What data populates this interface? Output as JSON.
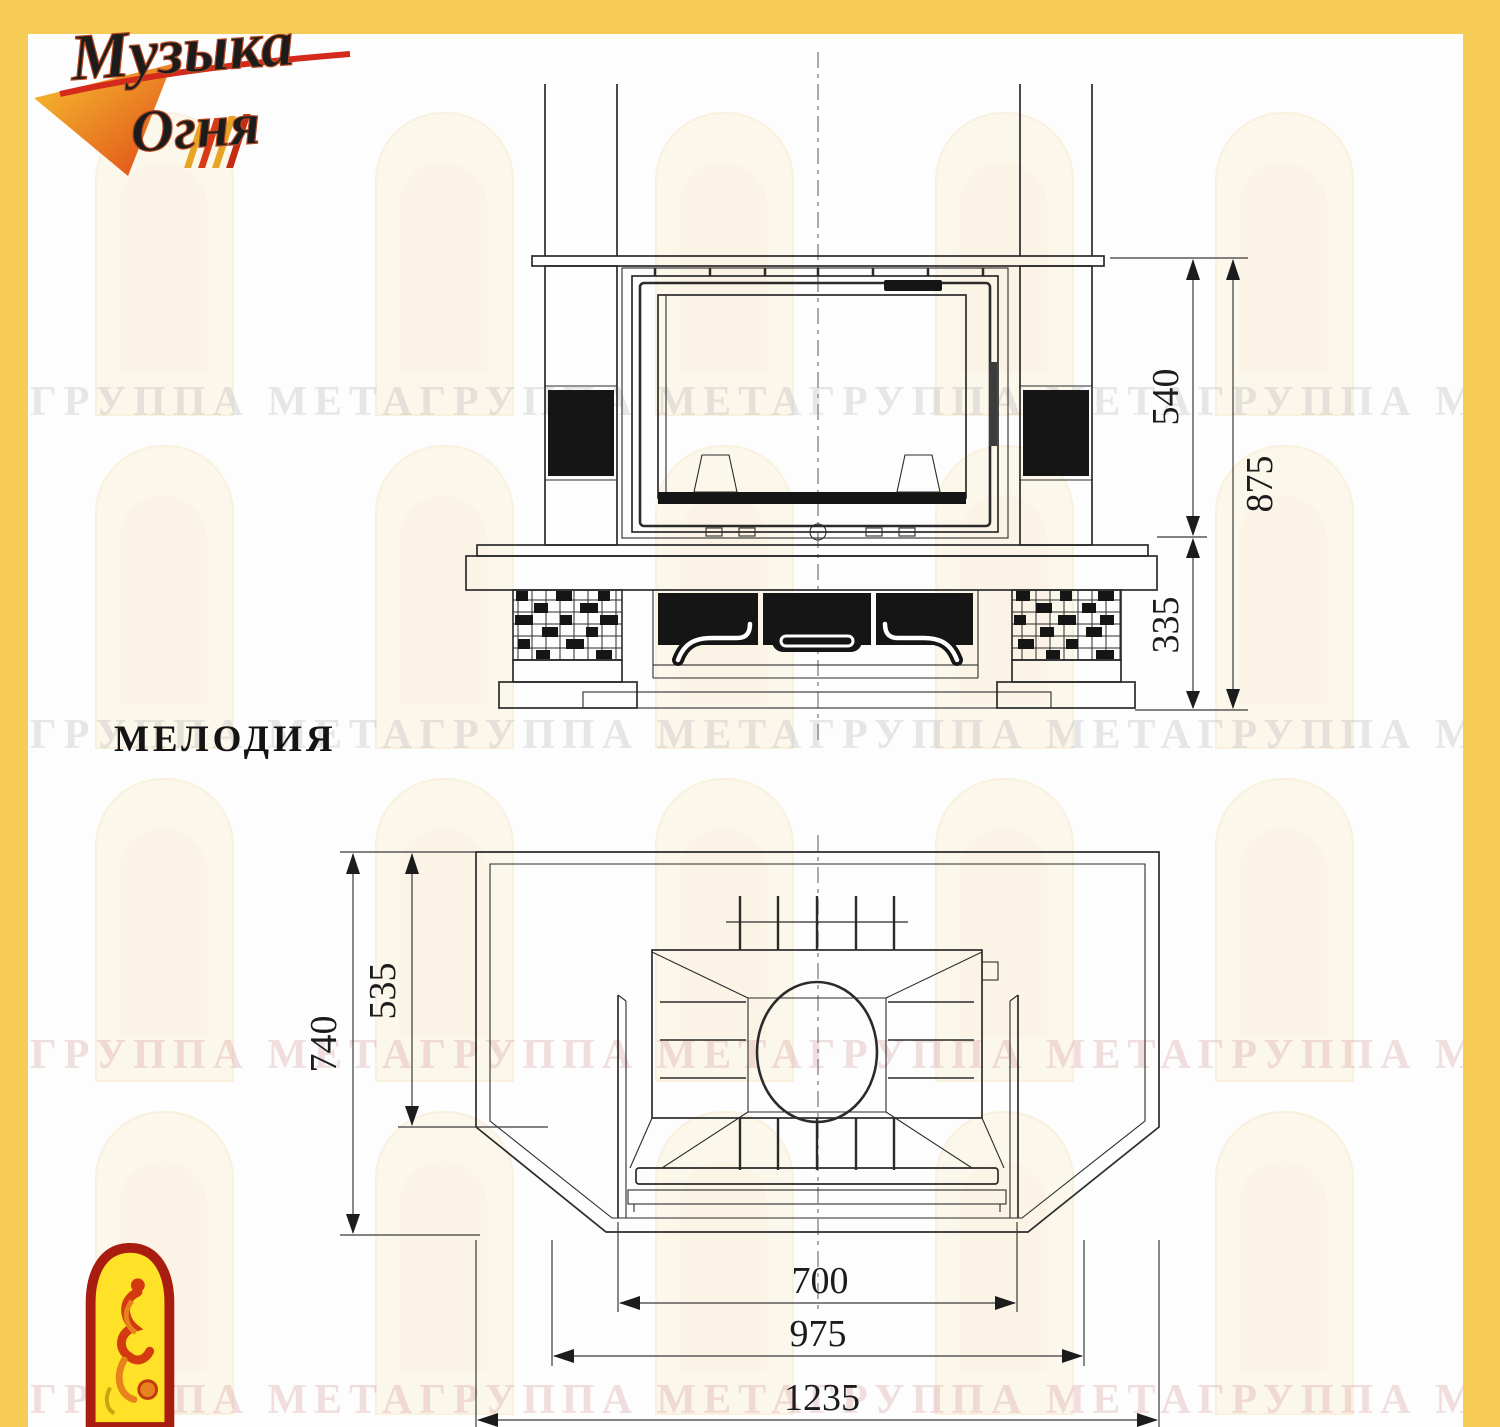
{
  "page": {
    "background": "#ffffff",
    "frame_color": "#F6CB56"
  },
  "logo": {
    "line1": "Музыка",
    "line2": "Огня"
  },
  "title": "МЕЛОДИЯ",
  "watermark": {
    "line": "ГРУППА МЕТАГРУППА МЕТАГРУППА МЕТАГРУППА МЕТА"
  },
  "front_view": {
    "dims": {
      "firebox_height": "540",
      "total_height": "875",
      "base_height": "335"
    }
  },
  "plan_view": {
    "dims": {
      "total_depth": "740",
      "inner_depth": "535",
      "firebox_width": "700",
      "inner_width": "975",
      "total_width": "1235"
    }
  }
}
